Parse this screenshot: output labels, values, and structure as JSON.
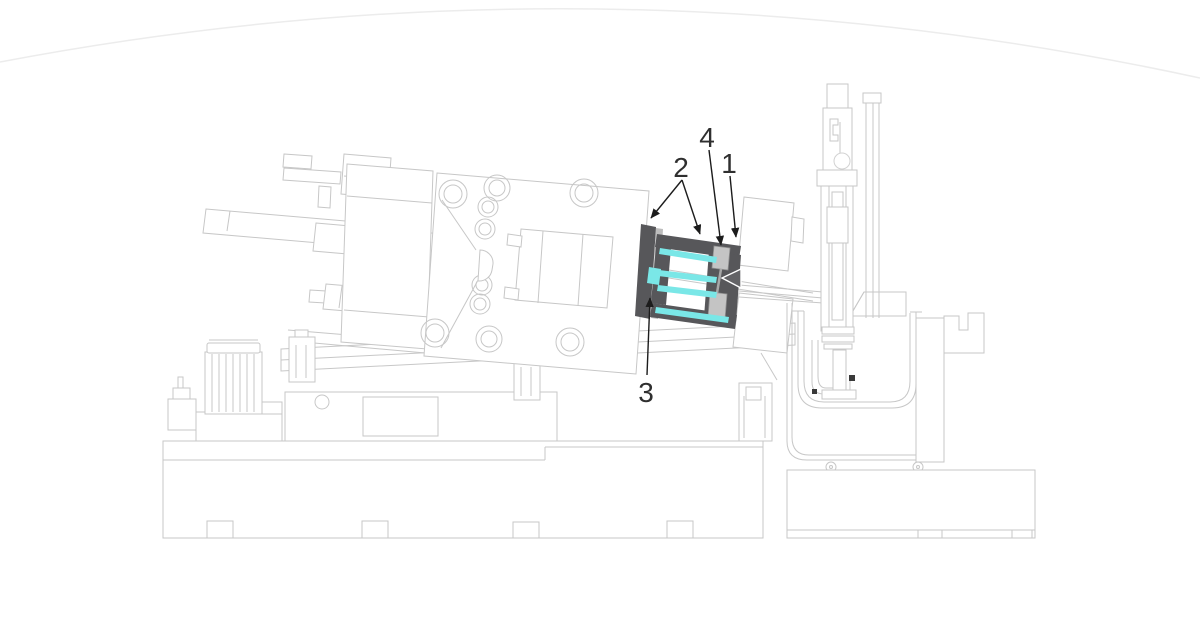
{
  "figure": {
    "type": "patent-style technical line diagram",
    "subject": "Die casting machine side view with highlighted die (mold) assembly",
    "background_color": "#ffffff"
  },
  "colors": {
    "machine_outline": "#c7c7c7",
    "faint_top_arc": "#ececec",
    "highlight_dark_gray": "#57575a",
    "highlight_cyan": "#7ae7e7",
    "insert_block_gray": "#c4c4c4",
    "leader_line_black": "#1c1c1c",
    "label_text": "#2f2f2f"
  },
  "labels": [
    {
      "text": "1",
      "target": "die-frame-right-section"
    },
    {
      "text": "2",
      "target": "die-clamping-plates"
    },
    {
      "text": "3",
      "target": "die-frame-left-bar"
    },
    {
      "text": "4",
      "target": "upper-insert-block"
    }
  ],
  "machine_parts": [
    "hydraulic-power-unit",
    "clamping-cylinders",
    "rear-platen",
    "moving-platen",
    "die-mount-block",
    "highlighted-die-assembly",
    "fixed-platen",
    "nozzle-rails",
    "vertical-injection-unit",
    "furnace-crucible",
    "furnace-enclosure",
    "machine-bed",
    "furnace-base"
  ]
}
